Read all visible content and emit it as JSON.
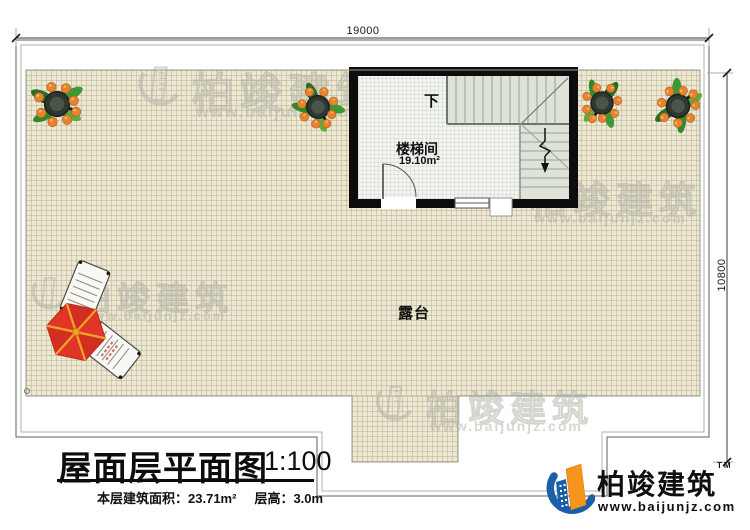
{
  "dims": {
    "top": "19000",
    "right": "10800"
  },
  "rooms": {
    "stair": {
      "name": "楼梯间",
      "area": "19.10m²",
      "direction": "下"
    },
    "terrace": {
      "name": "露台"
    }
  },
  "title_block": {
    "title": "屋面层平面图",
    "scale": "1:100",
    "area_label": "本层建筑面积：",
    "area_value": "23.71m²",
    "height_label": "层高：",
    "height_value": "3.0m"
  },
  "brand": {
    "name": "柏竣建筑",
    "trademark": "TM",
    "website": "www.baijunjz.com"
  },
  "watermark": {
    "name": "柏竣建筑",
    "website": "www.baijunjz.com"
  },
  "icons": {
    "plant": "potted-plant-icon",
    "umbrella": "parasol-icon",
    "chair": "lounge-chair-icon",
    "logo": "brand-logo-icon",
    "watermark_logo": "watermark-logo-icon"
  },
  "colors": {
    "tile": "#ece8d4",
    "wall": "#0d0d0d",
    "stair_fill": "#dde3d8",
    "brand_blue": "#1c5fa8",
    "brand_orange": "#f7941e",
    "umbrella_red": "#e03527",
    "umbrella_rib": "#f2a32b"
  }
}
